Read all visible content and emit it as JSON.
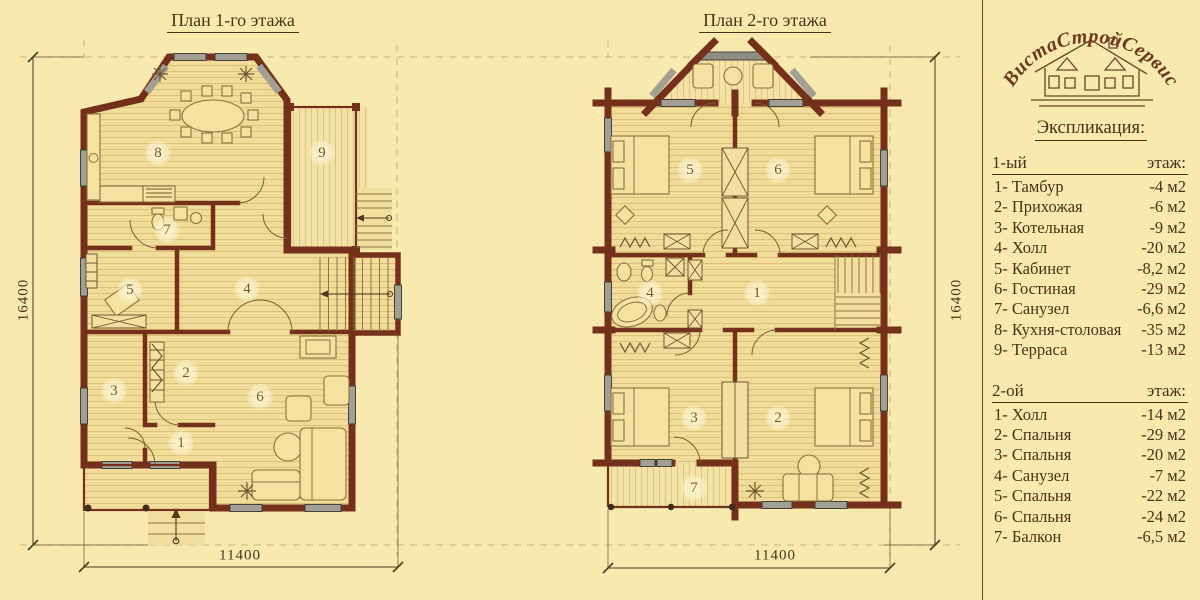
{
  "colors": {
    "background": "#f8e9ae",
    "walls": "#74301a",
    "text": "#4c3016"
  },
  "plans": [
    {
      "title": "План 1-го этажа",
      "dim_height": "16400",
      "dim_width": "11400",
      "rooms": [
        "1",
        "2",
        "3",
        "4",
        "5",
        "6",
        "7",
        "8",
        "9"
      ]
    },
    {
      "title": "План 2-го этажа",
      "dim_height": "16400",
      "dim_width": "11400",
      "rooms": [
        "1",
        "2",
        "3",
        "4",
        "5",
        "6",
        "7"
      ]
    }
  ],
  "legend": {
    "logo_text": "ВистаСтройСервис",
    "heading": "Экспликация:",
    "floors": [
      {
        "label": "1-ый",
        "label_right": "этаж:",
        "items": [
          {
            "name": "1- Тамбур",
            "area": "-4 м2"
          },
          {
            "name": "2- Прихожая",
            "area": "-6 м2"
          },
          {
            "name": "3- Котельная",
            "area": "-9 м2"
          },
          {
            "name": "4- Холл",
            "area": "-20 м2"
          },
          {
            "name": "5- Кабинет",
            "area": "-8,2 м2"
          },
          {
            "name": "6- Гостиная",
            "area": "-29 м2"
          },
          {
            "name": "7- Санузел",
            "area": "-6,6 м2"
          },
          {
            "name": "8- Кухня-столовая",
            "area": "-35 м2"
          },
          {
            "name": "9- Терраса",
            "area": "-13 м2"
          }
        ]
      },
      {
        "label": "2-ой",
        "label_right": "этаж:",
        "items": [
          {
            "name": "1- Холл",
            "area": "-14 м2"
          },
          {
            "name": "2- Спальня",
            "area": "-29 м2"
          },
          {
            "name": "3- Спальня",
            "area": "-20 м2"
          },
          {
            "name": "4- Санузел",
            "area": "-7 м2"
          },
          {
            "name": "5- Спальня",
            "area": "-22 м2"
          },
          {
            "name": "6- Спальня",
            "area": "-24 м2"
          },
          {
            "name": "7- Балкон",
            "area": "-6,5 м2"
          }
        ]
      }
    ]
  }
}
